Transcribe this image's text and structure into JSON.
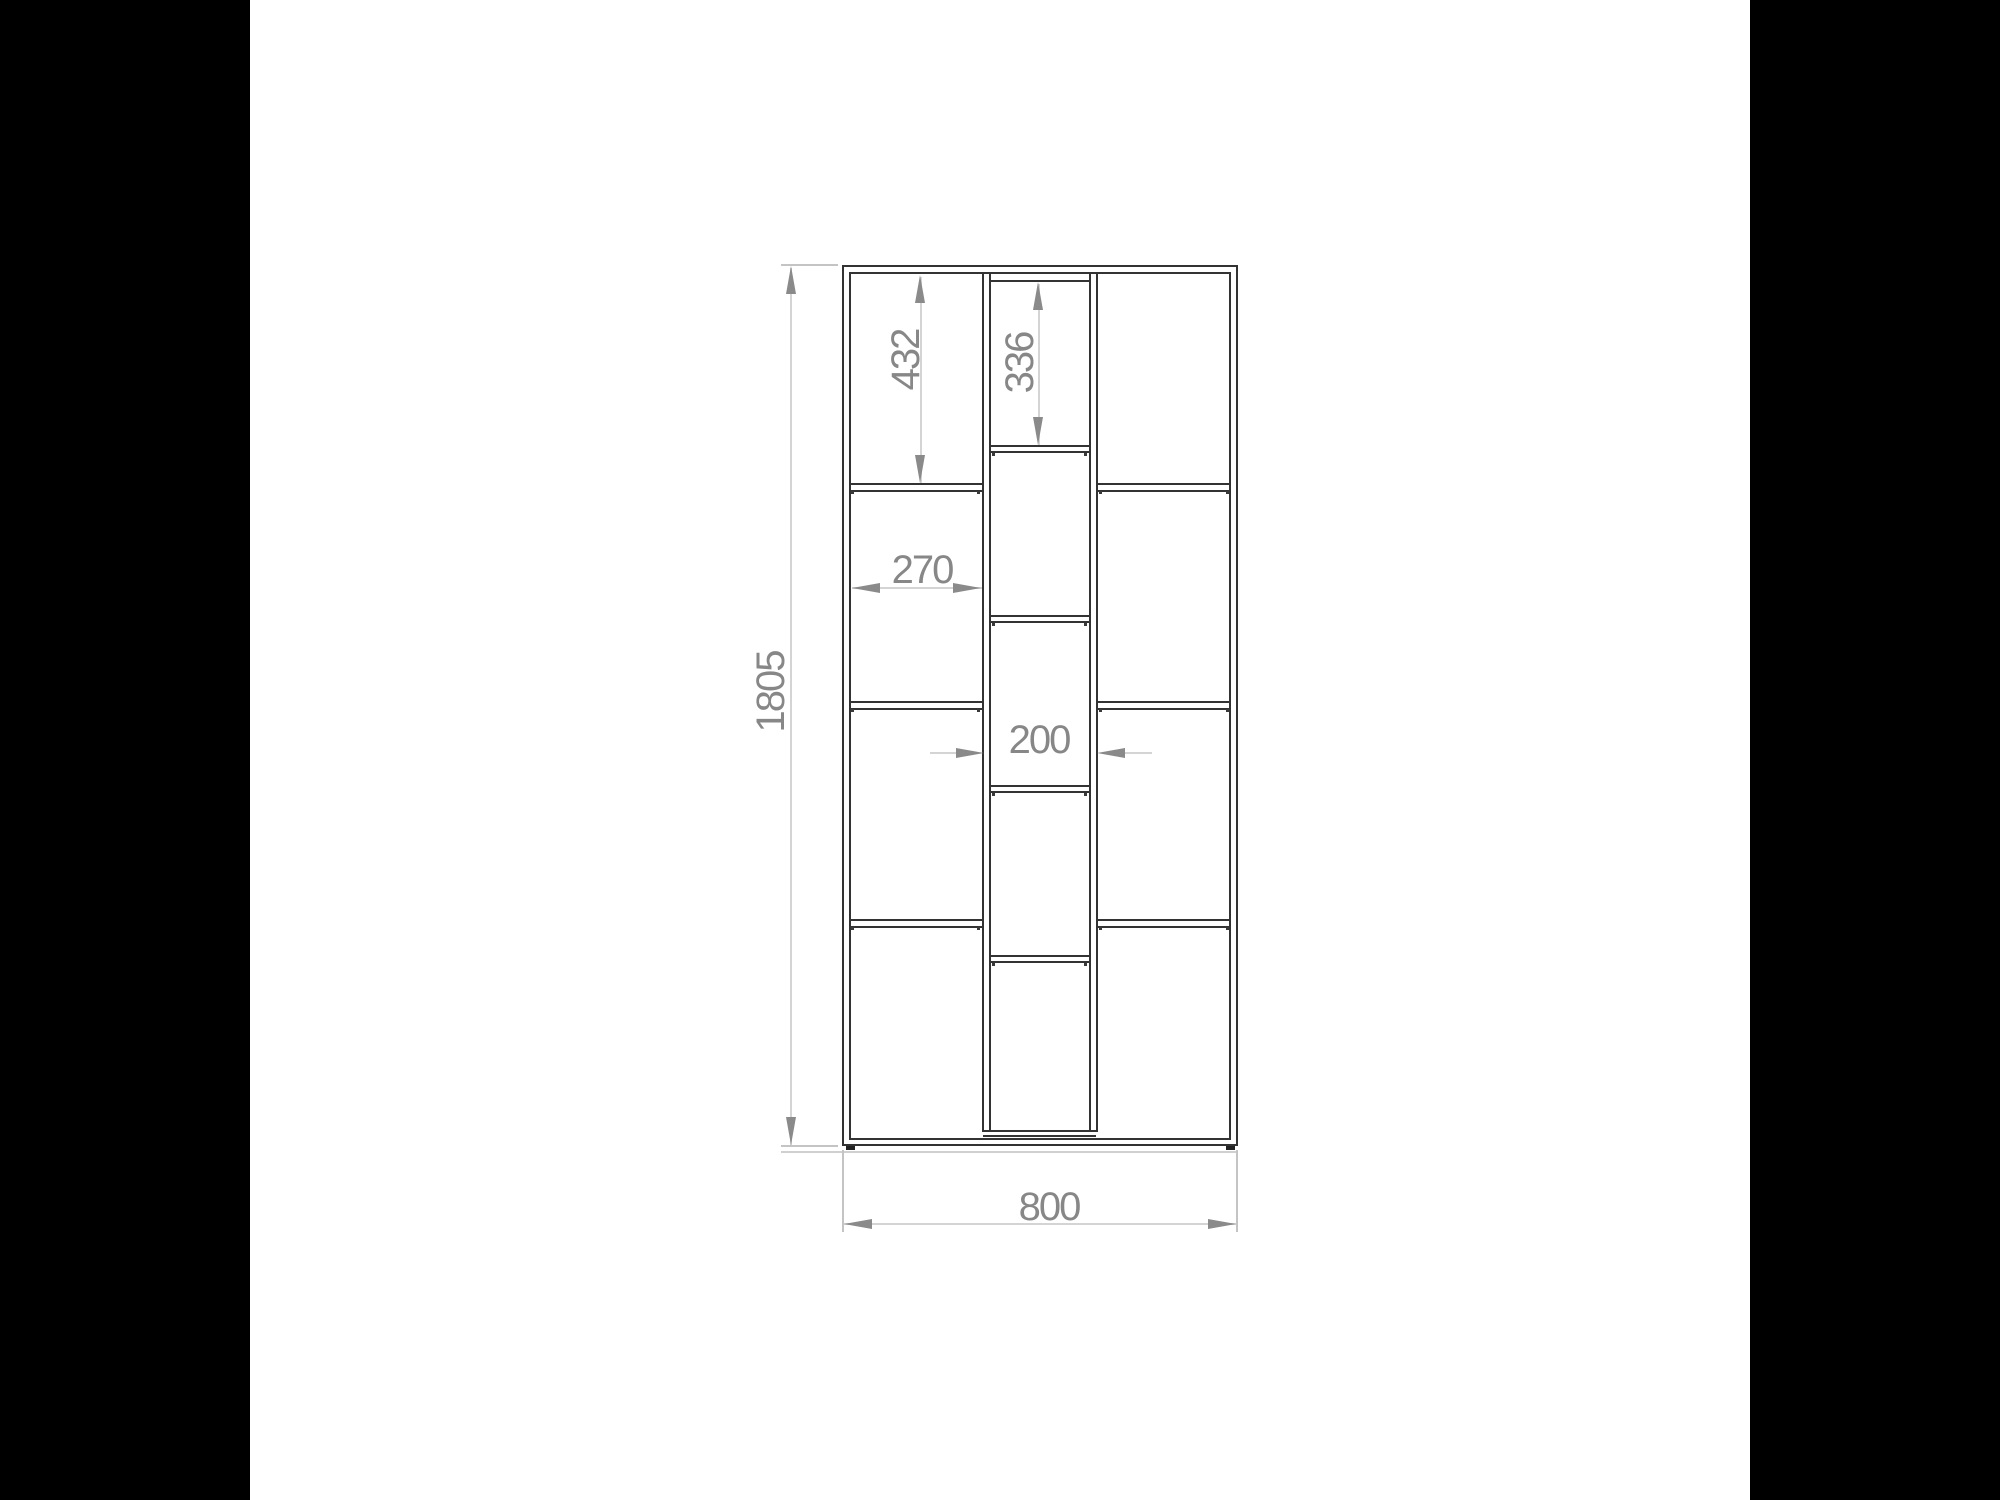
{
  "drawing": {
    "type": "furniture-technical-drawing",
    "subject": "tall staggered-shelf bookcase, front elevation",
    "labels": {
      "overall_height": "1805",
      "overall_width": "800",
      "outer_cell_height": "432",
      "center_cell_height": "336",
      "outer_cell_width": "270",
      "center_cell_width": "200"
    },
    "colors": {
      "letterbox": "#000000",
      "paper": "#ffffff",
      "cabinet_line": "#333333",
      "dimension_gray": "#8a8a8a",
      "faint_dimension_line": "#d4d4d4",
      "extension_line": "#c4c4c4"
    }
  }
}
